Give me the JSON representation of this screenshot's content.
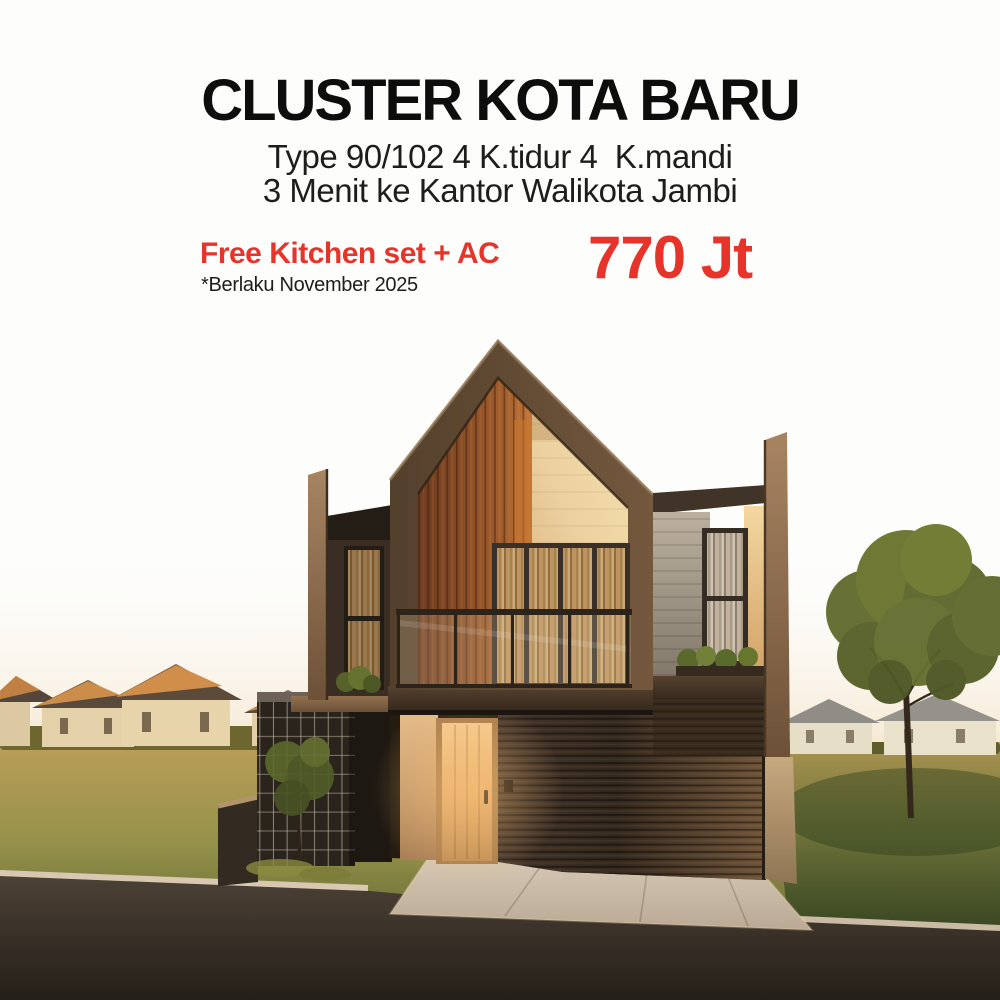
{
  "poster": {
    "headline": "CLUSTER KOTA BARU",
    "spec_line": "Type 90/102 4 K.tidur 4  K.mandi",
    "location_line": "3 Menit ke Kantor Walikota Jambi",
    "promo": "Free Kitchen set + AC",
    "promo_note": "*Berlaku November 2025",
    "price": "770 Jt"
  },
  "colors": {
    "accent_red": "#e7342b",
    "headline_black": "#0d0d0d",
    "body_text": "#1d1d1d",
    "house_frame_brown": "#5d4833",
    "wood_accent_orange": "#aa6531",
    "gable_cream": "#eed2a0",
    "grass_olive": "#8f8a45",
    "sky_white": "#fdfdfc"
  }
}
